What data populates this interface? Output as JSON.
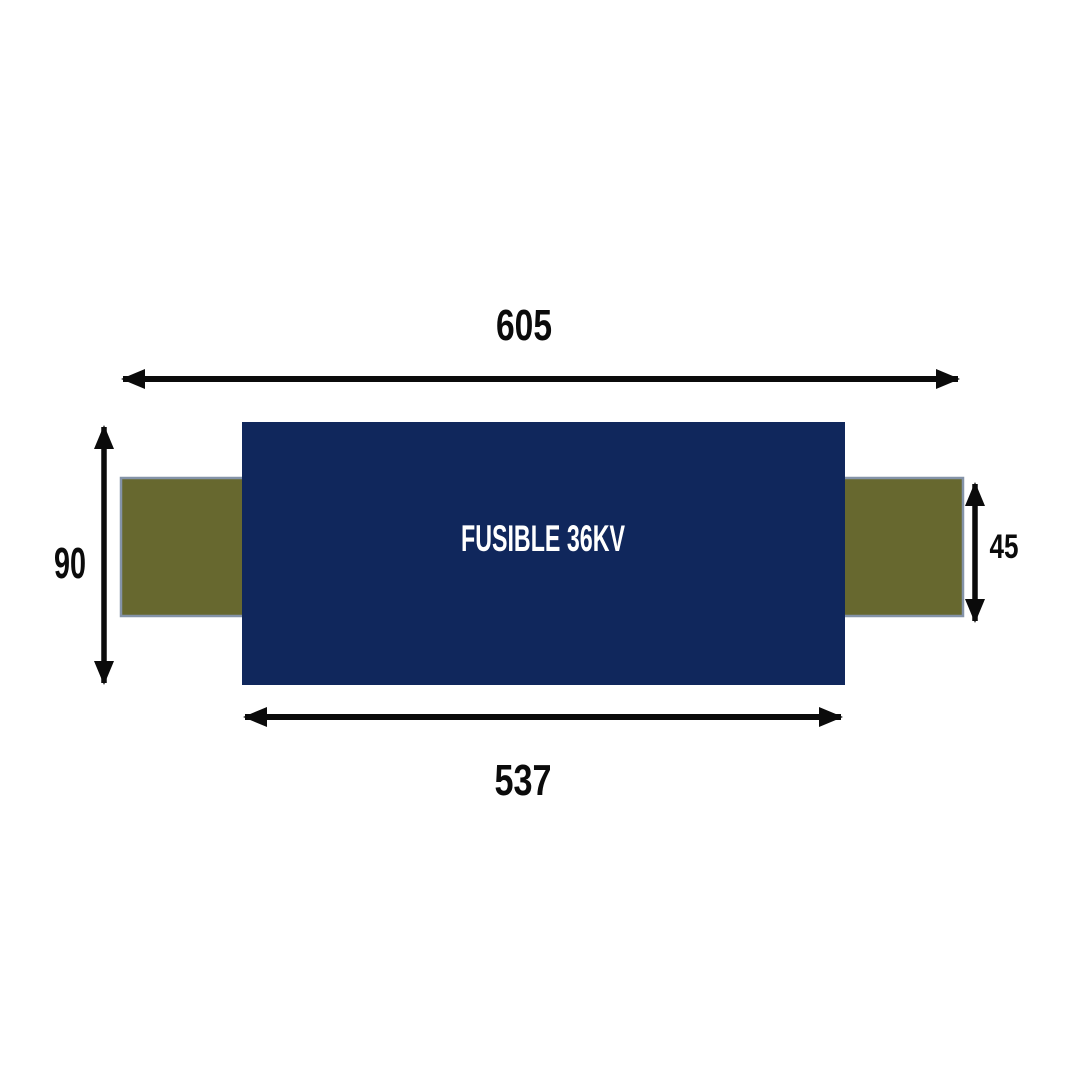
{
  "diagram": {
    "type": "technical-dimension-drawing",
    "fuse_label": "FUSIBLE 36KV",
    "dimensions": {
      "overall_length": "605",
      "body_length": "537",
      "body_height": "90",
      "cap_height": "45"
    },
    "colors": {
      "background": "#ffffff",
      "body_fill": "#10275c",
      "cap_fill": "#67682f",
      "cap_stroke": "#8493a8",
      "arrow": "#0b0b0b",
      "dim_text": "#0b0b0b",
      "label_text": "#ffffff"
    }
  }
}
